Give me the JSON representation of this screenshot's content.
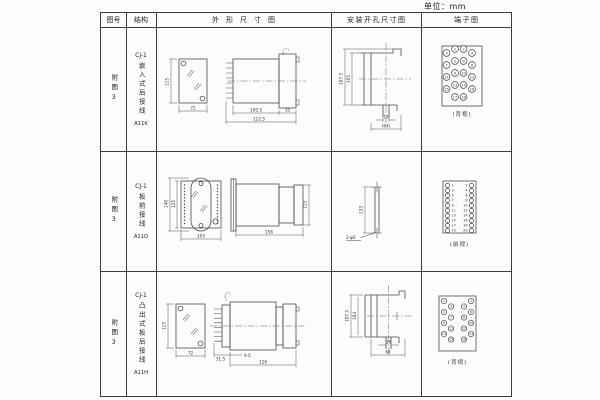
{
  "page": {
    "unit_label": "单位：mm"
  },
  "table": {
    "headers": {
      "figure": "图号",
      "structure": "结构",
      "outline": "外形尺寸图",
      "install": "安装开孔尺寸图",
      "terminal": "端子图"
    },
    "rows": [
      {
        "figure_no": "附图3",
        "model": "CJ-1",
        "structure_text": "嵌入式后接线",
        "code": "A11K",
        "outline": {
          "front_height": "115",
          "front_width": "72",
          "depth_body": "100.5",
          "depth_total": "122.5",
          "flange": "35"
        },
        "install": {
          "height_outer": "107.5",
          "height_inner": "105",
          "slot_width": "16",
          "width_ref": "(64)"
        },
        "terminal": {
          "view_label": "(背视)",
          "numbers": [
            1,
            2,
            3,
            4,
            5,
            6,
            7,
            8,
            9,
            10,
            11,
            12,
            13,
            14,
            15,
            16,
            17,
            18
          ]
        }
      },
      {
        "figure_no": "附图3",
        "model": "CJ-1",
        "structure_text": "板前接线",
        "code": "A11Q",
        "outline": {
          "plate_height": "140",
          "case_height": "125",
          "width": "105",
          "depth": "156",
          "side_height": "115"
        },
        "install": {
          "hole_spacing": "133",
          "hole_label": "2-φ6"
        },
        "terminal": {
          "view_label": "(前视)",
          "numbers_left": [
            1,
            3,
            5,
            7,
            9,
            11,
            13,
            15,
            17,
            19
          ],
          "numbers_right": [
            2,
            4,
            6,
            8,
            10,
            12,
            14,
            16,
            18,
            20
          ]
        }
      },
      {
        "figure_no": "附图3",
        "model": "CJ-1",
        "structure_text": "凸出式板后接线",
        "code": "A11H",
        "outline": {
          "front_height": "115",
          "front_width": "72",
          "pin_depth": "31.5",
          "offset": "9.5",
          "depth_total": "126"
        },
        "install": {
          "height_outer": "107.5",
          "height_inner": "104",
          "slot_width": "16",
          "width_ref": "64"
        },
        "terminal": {
          "view_label": "(背视)",
          "numbers": [
            1,
            2,
            3,
            4,
            5,
            6,
            7,
            8,
            9,
            10,
            11,
            12,
            13,
            14,
            15,
            16
          ]
        }
      }
    ]
  }
}
